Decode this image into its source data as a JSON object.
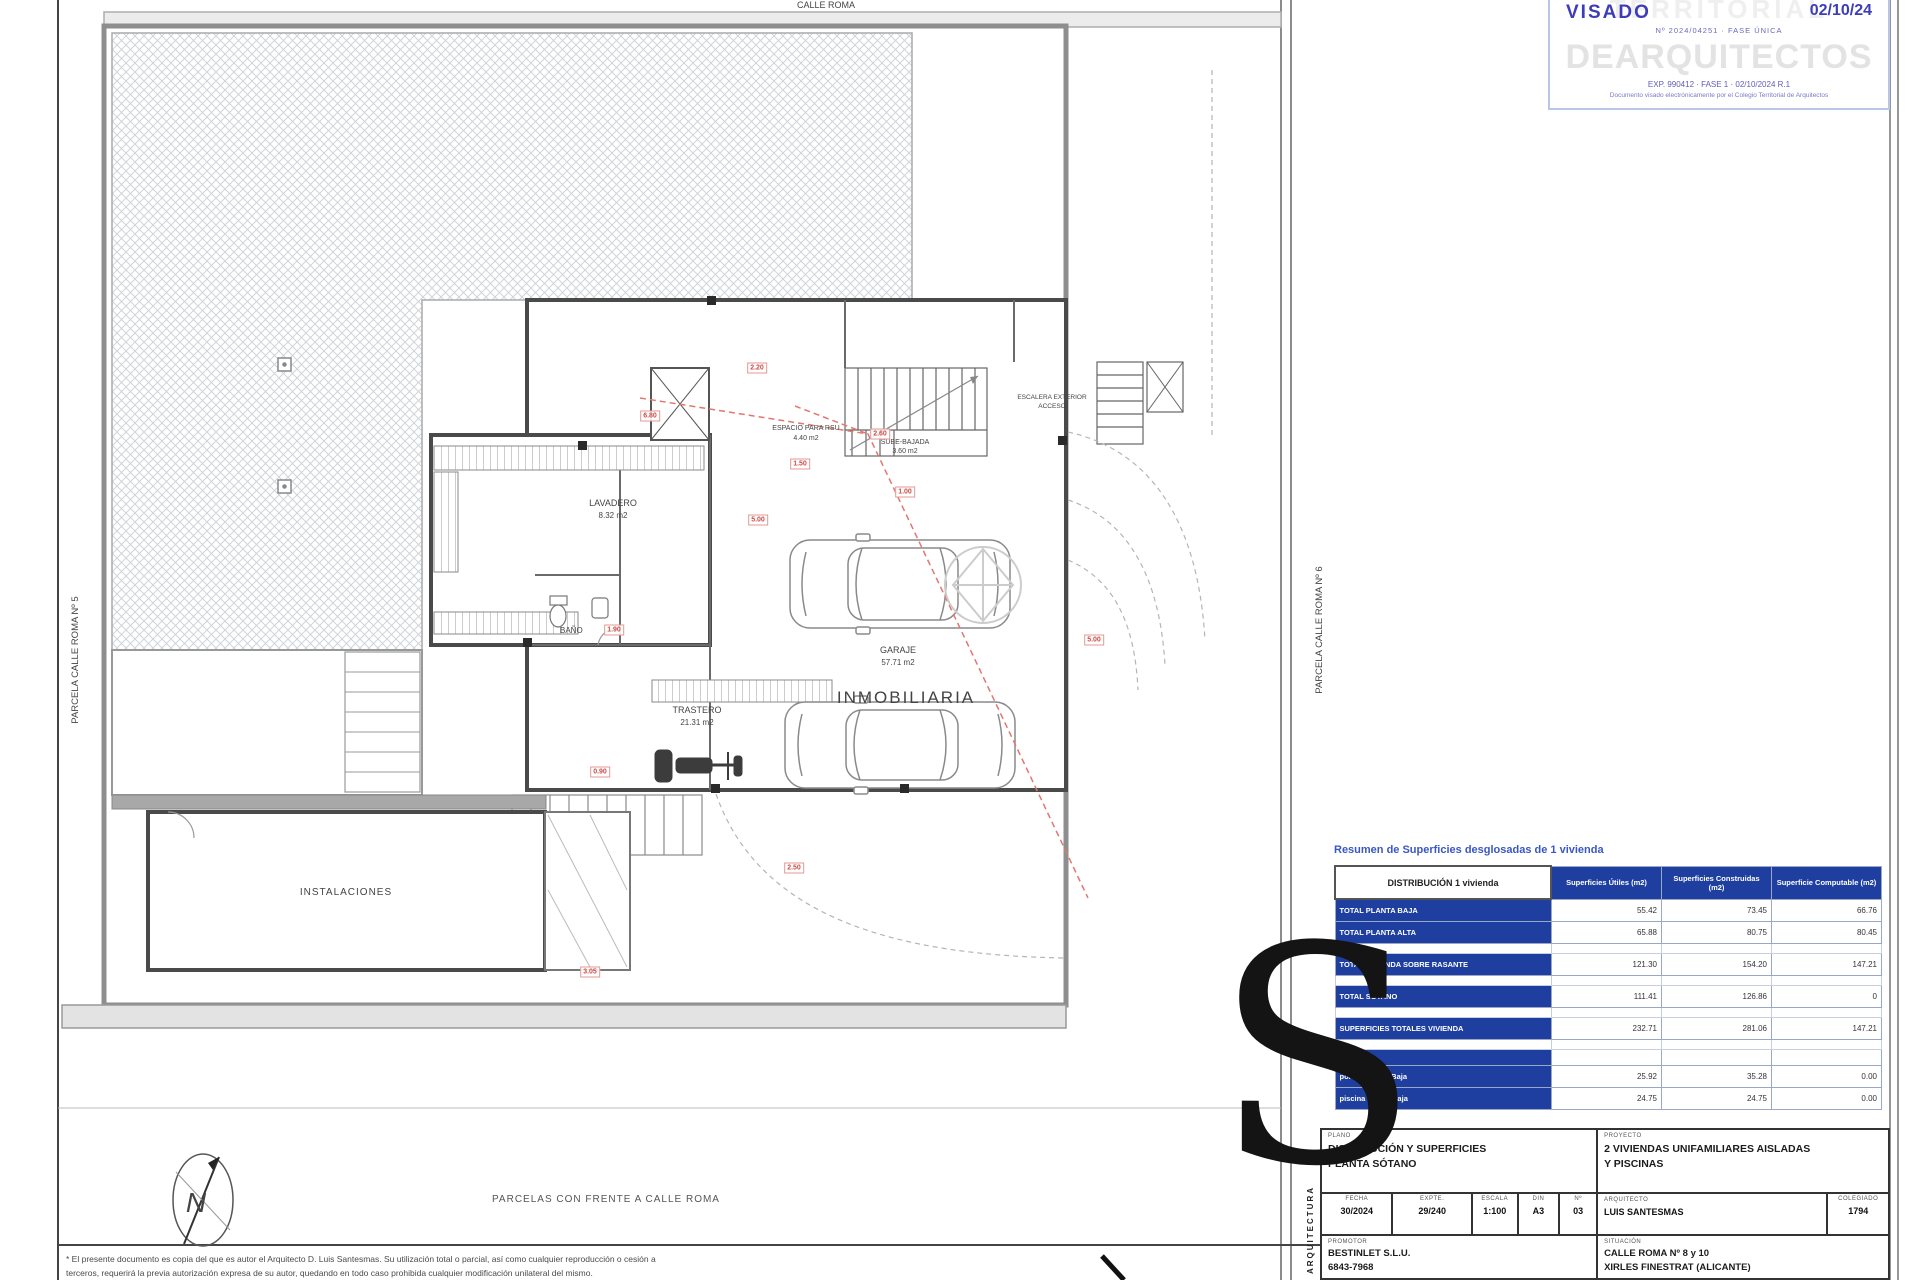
{
  "page": {
    "road_label": "CALLE ROMA",
    "caption": "PARCELAS CON FRENTE A CALLE ROMA",
    "parcel_left": "PARCELA CALLE ROMA Nº 5",
    "parcel_right": "PARCELA CALLE ROMA Nº 6"
  },
  "plan": {
    "lavadero": {
      "name": "LAVADERO",
      "area": "8.32 m2"
    },
    "garaje": {
      "name": "GARAJE",
      "area": "57.71 m2"
    },
    "trastero": {
      "name": "TRASTERO",
      "area": "21.31 m2"
    },
    "bano": {
      "name": "BAÑO"
    },
    "instalaciones": {
      "name": "INSTALACIONES"
    },
    "espacio": {
      "line1": "ESPACIO PARA RSU",
      "line2": "4.40 m2"
    },
    "escalera": {
      "line1": "SUBE-BAJADA",
      "line2": "3.60 m2"
    },
    "escalera_ext": {
      "line1": "ESCALERA EXTERIOR",
      "line2": "ACCESO"
    },
    "watermark_text": "INMOBILIARIA",
    "north_letter": "N"
  },
  "dimensions": {
    "tags": [
      "2.60",
      "6.80",
      "1.50",
      "5.00",
      "1.90",
      "0.90",
      "5.00",
      "2.50",
      "3.05",
      "1.00",
      "2.20"
    ]
  },
  "summary_table": {
    "title": "Resumen de Superficies desglosadas de 1 vivienda",
    "col0_header": "DISTRIBUCIÓN 1 vivienda",
    "col_headers": [
      "Superficies Útiles (m2)",
      "Superficies Construidas (m2)",
      "Superficie Computable (m2)"
    ],
    "rows": [
      {
        "type": "data",
        "label": "TOTAL PLANTA BAJA",
        "values": [
          "55.42",
          "73.45",
          "66.76"
        ]
      },
      {
        "type": "data",
        "label": "TOTAL PLANTA ALTA",
        "values": [
          "65.88",
          "80.75",
          "80.45"
        ]
      },
      {
        "type": "spacer"
      },
      {
        "type": "data",
        "label": "TOTAL VIVIENDA SOBRE RASANTE",
        "values": [
          "121.30",
          "154.20",
          "147.21"
        ]
      },
      {
        "type": "spacer"
      },
      {
        "type": "data",
        "label": "TOTAL SÓTANO",
        "values": [
          "111.41",
          "126.86",
          "0"
        ]
      },
      {
        "type": "spacer"
      },
      {
        "type": "data",
        "label": "SUPERFICIES TOTALES VIVIENDA",
        "values": [
          "232.71",
          "281.06",
          "147.21"
        ]
      },
      {
        "type": "spacer"
      },
      {
        "type": "section",
        "label": "ANEXOS"
      },
      {
        "type": "data",
        "label": "porche Planta Baja",
        "values": [
          "25.92",
          "35.28",
          "0.00"
        ]
      },
      {
        "type": "data",
        "label": "piscina Planta Baja",
        "values": [
          "24.75",
          "24.75",
          "0.00"
        ]
      }
    ]
  },
  "stamp": {
    "visado_label": "VISADO",
    "visado_date": "02/10/24",
    "subline": "Nº 2024/04251 · FASE ÚNICA",
    "watermark_top": "TERRITORIAL",
    "watermark_main": "DEARQUITECTOS",
    "line3": "EXP. 990412  ·  FASE 1  ·  02/10/2024 R.1",
    "line4": "Documento visado electrónicamente por el Colegio Territorial de Arquitectos"
  },
  "title_block": {
    "plano_label": "PLANO",
    "plano_line1": "DISTRIBUCIÓN Y SUPERFICIES",
    "plano_line2": "PLANTA SÓTANO",
    "proyecto_label": "PROYECTO",
    "proyecto_line1": "2 VIVIENDAS UNIFAMILIARES AISLADAS",
    "proyecto_line2": "Y PISCINAS",
    "fecha_label": "FECHA",
    "fecha_value": "30/2024",
    "expte_label": "EXPTE.",
    "expte_value": "29/240",
    "escala_label": "ESCALA",
    "escala_value": "1:100",
    "din_label": "DIN",
    "din_value": "A3",
    "num_label": "Nº",
    "num_value": "03",
    "arquitecto_label": "ARQUITECTO",
    "arquitecto_value": "LUIS SANTESMAS",
    "colegiado_label": "COLEGIADO",
    "colegiado_value": "1794",
    "promotor_label": "PROMOTOR",
    "promotor_line1": "BESTINLET S.L.U.",
    "promotor_line2": "6843-7968",
    "situacion_label": "SITUACIÓN",
    "situacion_line1": "CALLE ROMA Nº 8 y 10",
    "situacion_line2": "XIRLES FINESTRAT (ALICANTE)"
  },
  "brand": {
    "letter": "S",
    "vertical_text": "ARQUITECTURA"
  },
  "footer": {
    "disclaimer_line1": "* El presente documento es copia del que es autor el Arquitecto D. Luis Santesmas. Su utilización total o parcial, así como cualquier reproducción o cesión a",
    "disclaimer_line2": "terceros, requerirá la previa autorización expresa de su autor, quedando en todo caso prohibida cualquier modificación unilateral del mismo."
  }
}
